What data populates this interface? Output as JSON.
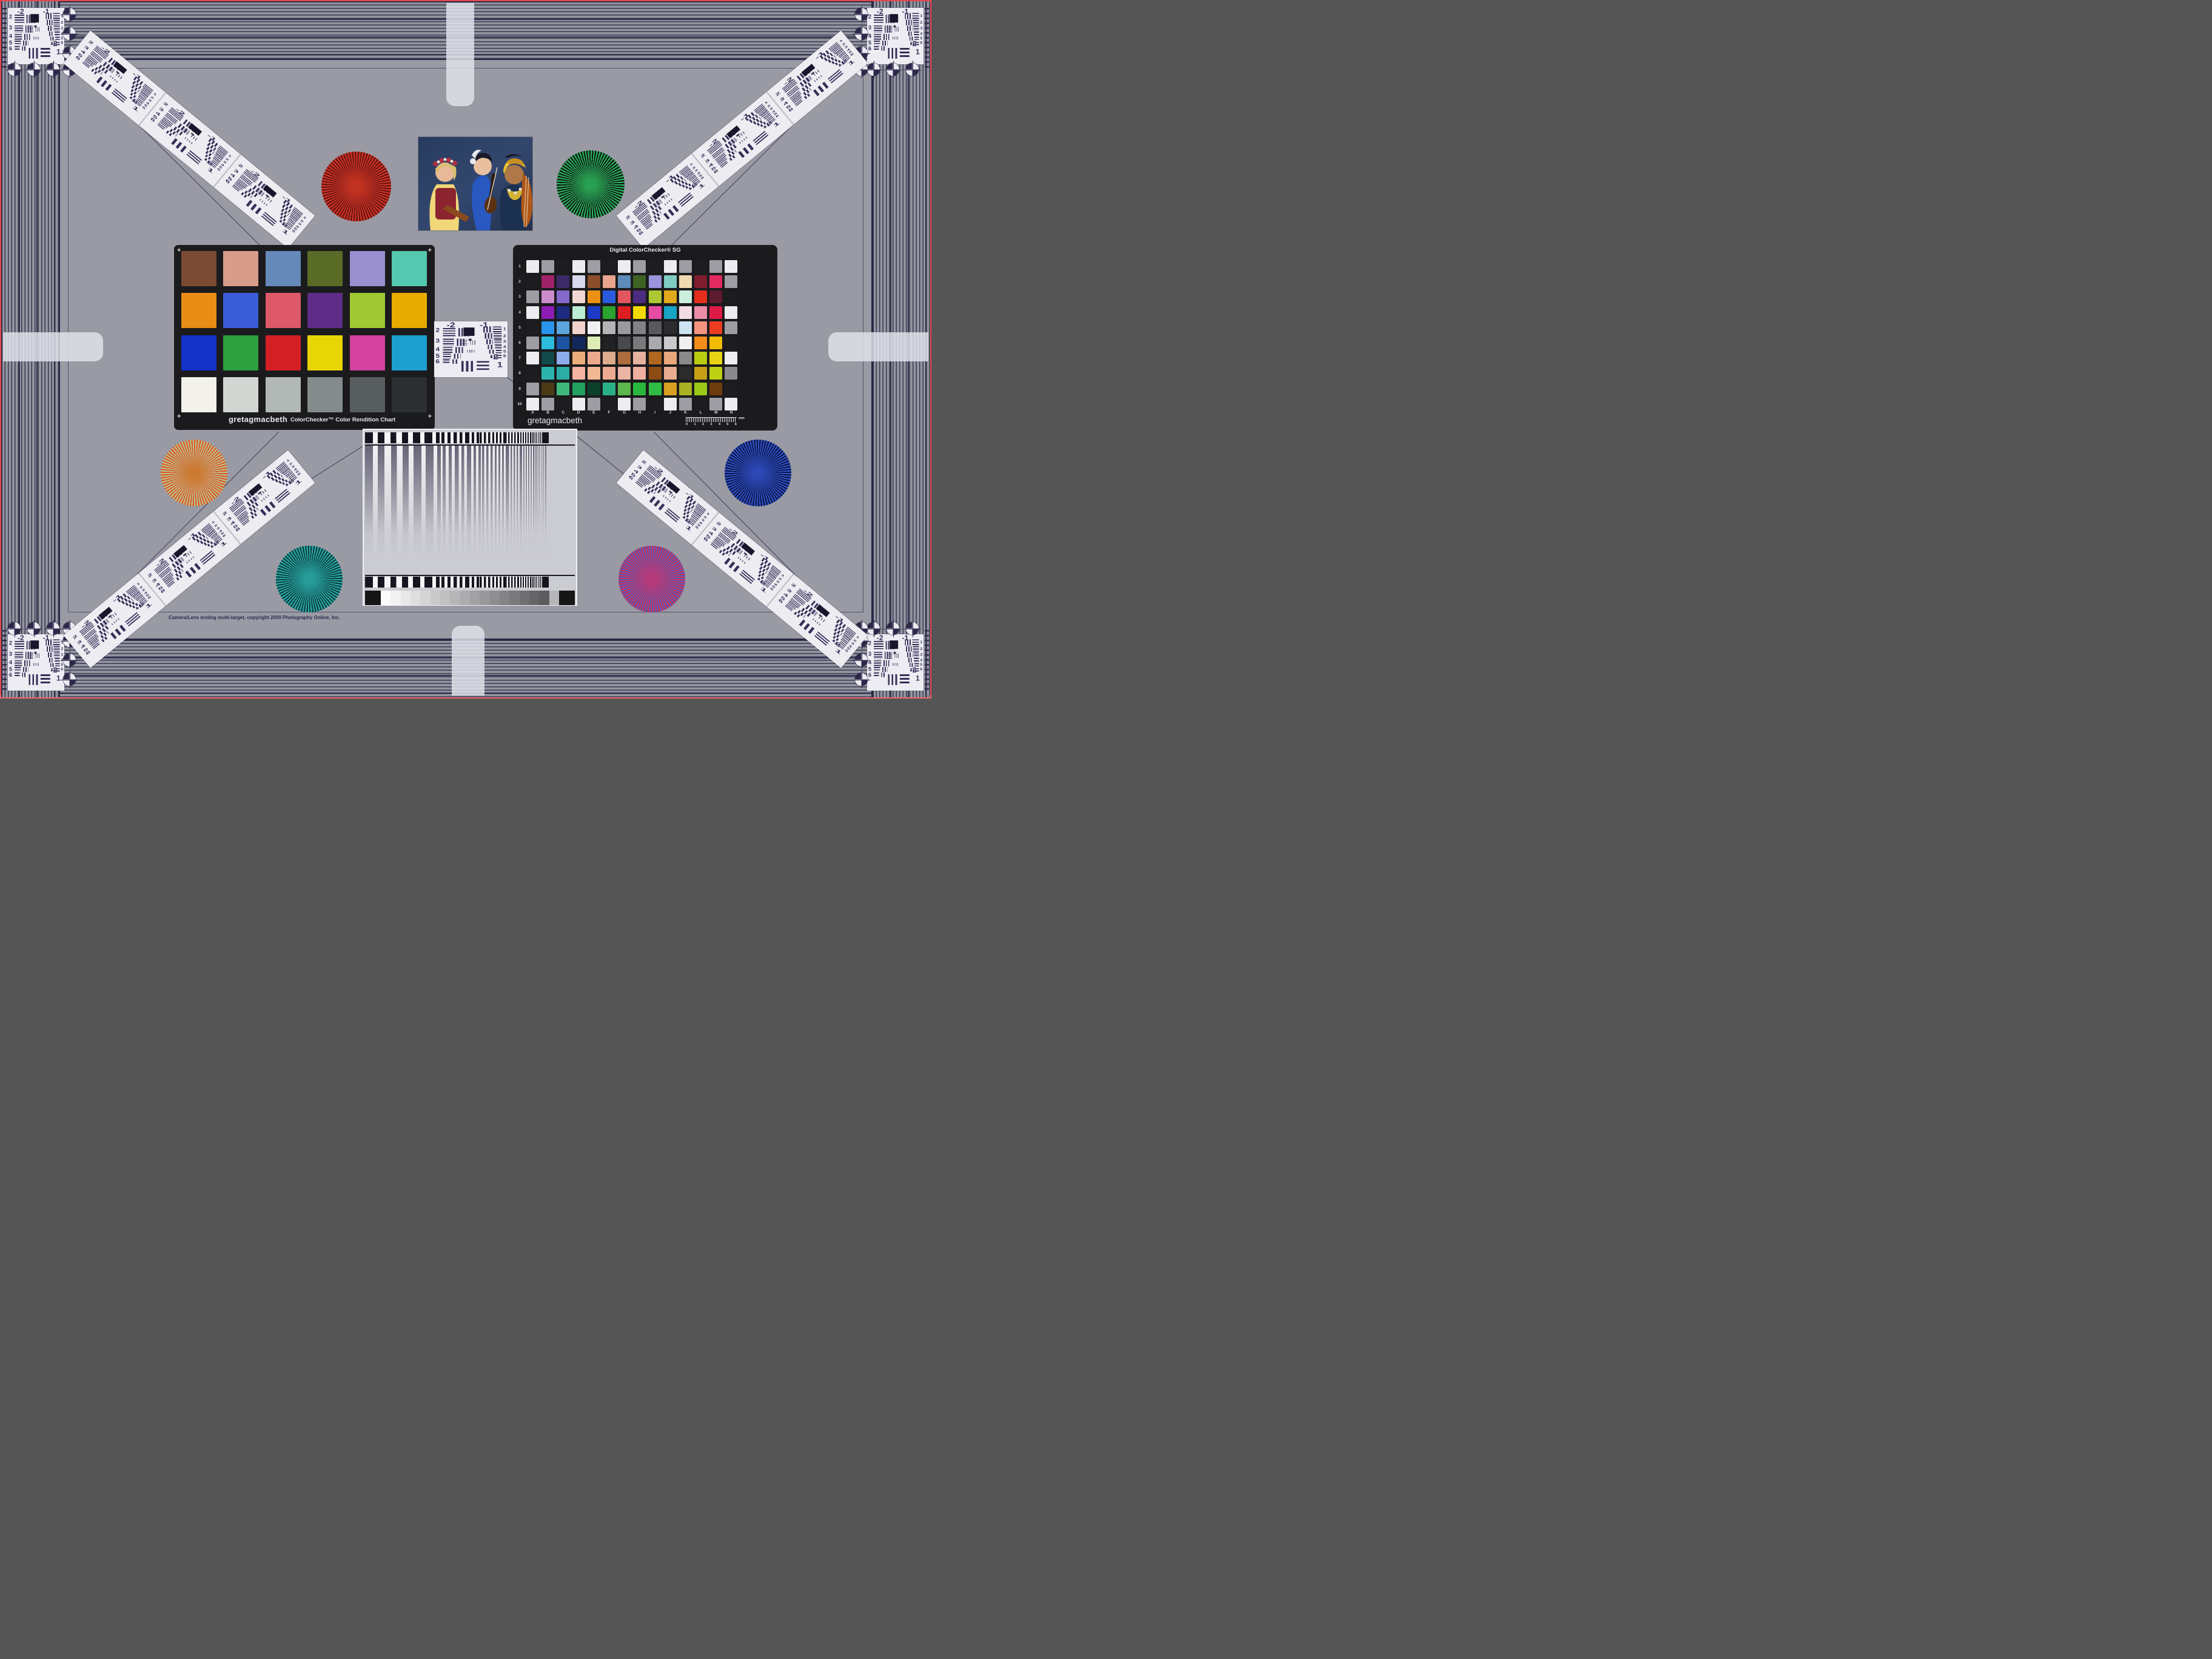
{
  "page": {
    "copyright": "Camera/Lens testing multi-target, copyright 2009 Photography Online, Inc."
  },
  "colorchecker": {
    "brand": "gretagmacbeth",
    "title": "ColorChecker™ Color Rendition Chart",
    "corner_mark": "+",
    "patches": [
      "#7a4b32",
      "#d89c8a",
      "#6589b8",
      "#5a6b28",
      "#9a90d0",
      "#55c8b0",
      "#e88d15",
      "#3a5cd8",
      "#dd5868",
      "#5f2d88",
      "#a0c832",
      "#e8ab00",
      "#1232c8",
      "#2ba03c",
      "#d42025",
      "#e8d506",
      "#d2429e",
      "#1ba0d0",
      "#f2f2ea",
      "#d2d6d2",
      "#b2b8b5",
      "#838c8a",
      "#585e5e",
      "#2c2f32"
    ]
  },
  "sg": {
    "title": "Digital ColorChecker® SG",
    "brand": "gretagmacbeth",
    "row_labels": [
      "1",
      "2",
      "3",
      "4",
      "5",
      "6",
      "7",
      "8",
      "9",
      "10"
    ],
    "col_labels": [
      "A",
      "B",
      "C",
      "D",
      "E",
      "F",
      "G",
      "H",
      "I",
      "J",
      "K",
      "L",
      "M",
      "N"
    ],
    "ruler_numbers": [
      "0",
      "1",
      "2",
      "3",
      "4",
      "5",
      "6"
    ],
    "ruler_unit": "mm",
    "rows": [
      [
        "#ededf0",
        "#9d9da3",
        "#1d1d1f",
        "#ededf0",
        "#9d9da3",
        "#1d1d1f",
        "#ededf0",
        "#9d9da3",
        "#1d1d1f",
        "#ededf0",
        "#9d9da3",
        "#1d1d1f",
        "#9d9da3",
        "#ededf0"
      ],
      [
        "#1d1d1f",
        "#a02268",
        "#3c2a68",
        "#d8d8ec",
        "#8c4e2c",
        "#e8a48c",
        "#5e8cba",
        "#3e6222",
        "#9a94dc",
        "#7eccc2",
        "#eedab2",
        "#801c2e",
        "#e22a60",
        "#9d9da3"
      ],
      [
        "#9d9da3",
        "#cc8ccc",
        "#8468cc",
        "#f2d6d4",
        "#eb9214",
        "#2a5ade",
        "#e25660",
        "#4c2c80",
        "#abc832",
        "#e2aa1a",
        "#cceedc",
        "#e62e1e",
        "#5e1a2e",
        "#1d1d1f"
      ],
      [
        "#ededf0",
        "#8c1cb4",
        "#1c2c80",
        "#bcecd4",
        "#1c3ac6",
        "#2aa42e",
        "#de1e20",
        "#f2da00",
        "#e64ca6",
        "#18a4c4",
        "#f2dce4",
        "#ec8ca6",
        "#de1a46",
        "#ededf0"
      ],
      [
        "#1d1d1f",
        "#2a94ec",
        "#5ca4dc",
        "#f2d4cc",
        "#f0f0f0",
        "#b4b4b6",
        "#9a9a9c",
        "#828284",
        "#5a5a5c",
        "#2c2c2e",
        "#cce4f2",
        "#f49480",
        "#ec3c22",
        "#9d9da3"
      ],
      [
        "#9d9da3",
        "#2cbcdc",
        "#1c54a4",
        "#12285c",
        "#dcecb4",
        "#222224",
        "#4a4a4c",
        "#7a7a7c",
        "#aaaaac",
        "#cacacc",
        "#f0f0f0",
        "#f48c1c",
        "#f2bc02",
        "#1d1d1f"
      ],
      [
        "#ededf0",
        "#124a4c",
        "#8cacec",
        "#ecac7c",
        "#eca98c",
        "#dcac8c",
        "#ac6c3c",
        "#e6b2a0",
        "#b06820",
        "#e8a87c",
        "#8a8a8a",
        "#b8cc10",
        "#e8d414",
        "#ededf0"
      ],
      [
        "#1d1d1f",
        "#2cb4ac",
        "#2caca4",
        "#f4b4a4",
        "#f2b896",
        "#ecab90",
        "#ecb4a4",
        "#eeb0a0",
        "#8c4c14",
        "#e8ac90",
        "#2c2c2c",
        "#c8a018",
        "#bcd014",
        "#8a8a8c"
      ],
      [
        "#9d9da3",
        "#4a3a16",
        "#40b87c",
        "#22a060",
        "#0c402a",
        "#2ab088",
        "#5cb84c",
        "#28b83c",
        "#30bc44",
        "#d8a022",
        "#a8b024",
        "#9cc818",
        "#6c3c0e",
        "#1d1d1f"
      ],
      [
        "#ededf0",
        "#9d9da3",
        "#1d1d1f",
        "#ededf0",
        "#9d9da3",
        "#1d1d1f",
        "#ededf0",
        "#9d9da3",
        "#1d1d1f",
        "#ededf0",
        "#9d9da3",
        "#1d1d1f",
        "#9d9da3",
        "#ededf0"
      ]
    ]
  },
  "usaf": {
    "top_left_label": "-2",
    "top_right_label": "-1",
    "left_numbers": [
      "2",
      "3",
      "4",
      "5",
      "6"
    ],
    "right_numbers": [
      "1",
      "2",
      "3",
      "4",
      "5",
      "6"
    ],
    "bottom_label_neg2": "-2",
    "bottom_label_one": "1"
  },
  "stars": [
    {
      "name": "red-star",
      "bright": "#d23428",
      "dark": "#641410",
      "center": "#c23220"
    },
    {
      "name": "green-star",
      "bright": "#2eb060",
      "dark": "#0c1a10",
      "center": "#28a052"
    },
    {
      "name": "orange-green-star",
      "bright": "#de5328",
      "dark": "#b6c78e",
      "center": "#cc7a32"
    },
    {
      "name": "teal-star",
      "bright": "#2aacaa",
      "dark": "#0a3a3a",
      "center": "#269c9a"
    },
    {
      "name": "blue-star",
      "bright": "#3152c8",
      "dark": "#0c1546",
      "center": "#2b48b4"
    },
    {
      "name": "red-blue-star",
      "bright": "#cc3456",
      "dark": "#5756bc",
      "center": "#b43a7a"
    }
  ],
  "sweep": {
    "bar_pitches": [
      26,
      22,
      19,
      16,
      14,
      12,
      10,
      9,
      8,
      7,
      6,
      5,
      4,
      3.2
    ],
    "wedge": [
      "#161616",
      "#fbfbfb",
      "#f2f2f2",
      "#e8e8e8",
      "#dedede",
      "#d4d4d4",
      "#cacaca",
      "#c0c0c0",
      "#b6b6b8",
      "#acacae",
      "#a2a2a4",
      "#98989a",
      "#8e8e90",
      "#848486",
      "#7a7a7c",
      "#707072",
      "#666668",
      "#5c5c5e",
      "#b4b6ba",
      "#161616"
    ]
  }
}
